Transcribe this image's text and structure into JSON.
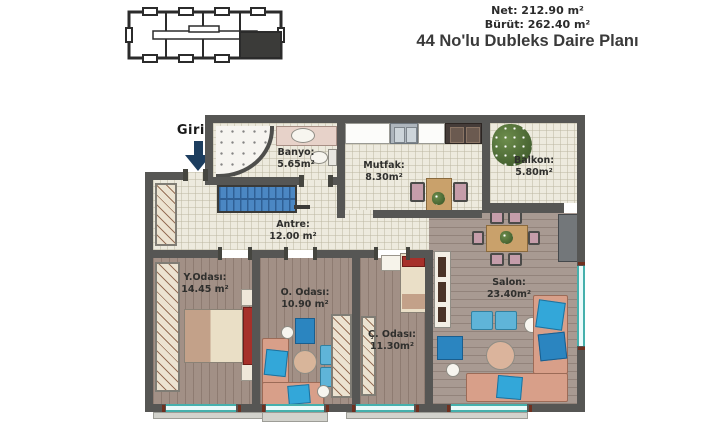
{
  "header": {
    "net": "Net: 212.90 m²",
    "brut": "Bürüt: 262.40 m²",
    "title": "44 No'lu Dubleks Daire Planı"
  },
  "entrance": {
    "label": "Giriş"
  },
  "rooms": {
    "banyo": {
      "name": "Banyo:",
      "area": "5.65m²"
    },
    "mutfak": {
      "name": "Mutfak:",
      "area": "8.30m²"
    },
    "balkon": {
      "name": "Balkon:",
      "area": "5.80m²"
    },
    "antre": {
      "name": "Antre:",
      "area": "12.00 m²"
    },
    "y_odasi": {
      "name": "Y.Odası:",
      "area": "14.45 m²"
    },
    "o_odasi": {
      "name": "O. Odası:",
      "area": "10.90 m²"
    },
    "c_odasi": {
      "name": "Ç. Odası:",
      "area": "11.30m²"
    },
    "salon": {
      "name": "Salon:",
      "area": "23.40m²"
    }
  },
  "colors": {
    "wall": "#565654",
    "tile_floor": "#edeade",
    "wood_floor": "#a29086",
    "stairs_blue": "#4b87c3",
    "window_teal": "#45b0ac",
    "arrow_navy": "#1d3e5f",
    "sofa_salmon": "#d89f89",
    "cushion_cyan": "#33a7d9",
    "bed_red": "#a6302a"
  }
}
